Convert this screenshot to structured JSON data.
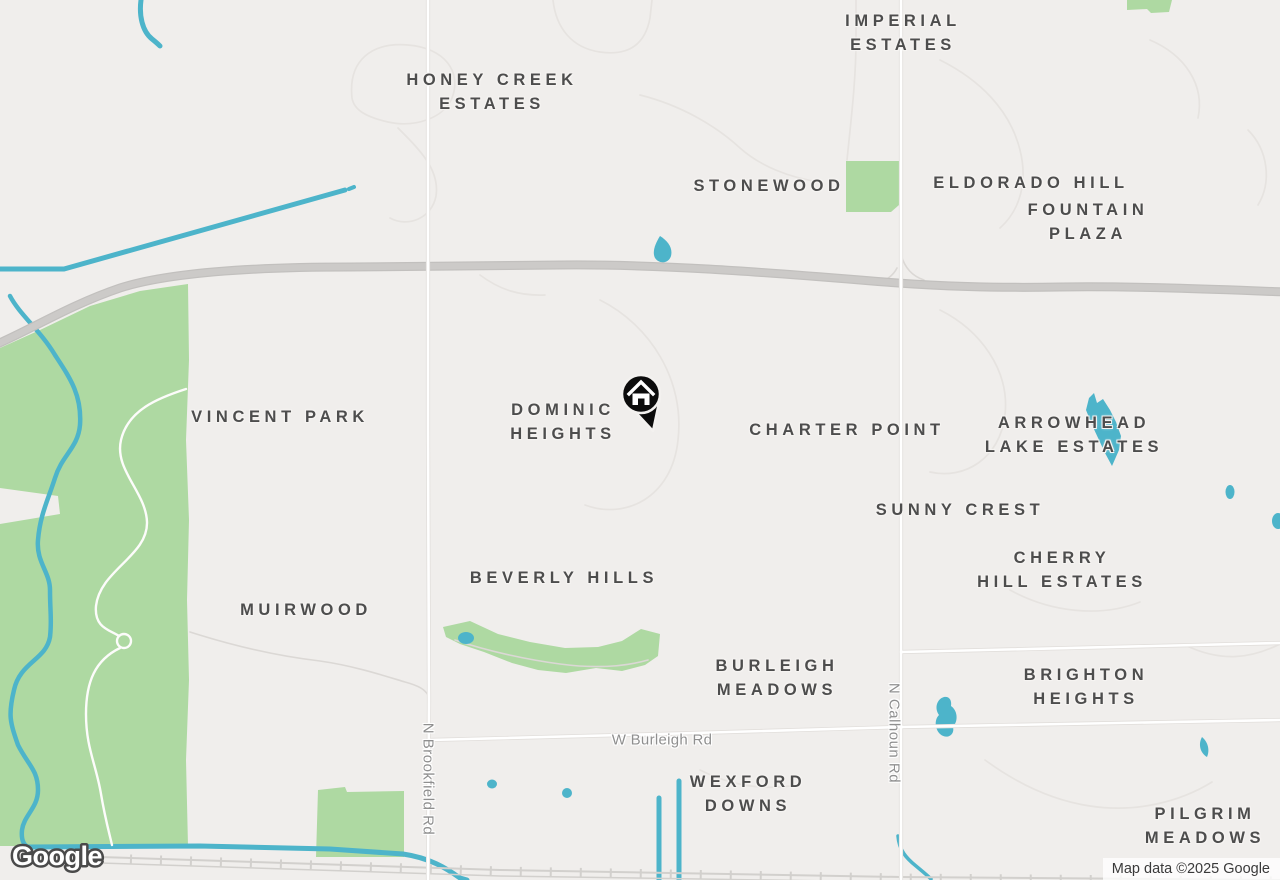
{
  "branding": {
    "logo_text": "Google",
    "attribution": "Map data ©2025 Google"
  },
  "marker": {
    "name": "home marker",
    "icon": "house-icon",
    "color": "#0c0c0c"
  },
  "colors": {
    "background": "#f0eeec",
    "park_green": "#aed9a2",
    "water_blue": "#4db4ca",
    "highway_gray": "#c9c7c5",
    "railroad_gray": "#d2d0cd",
    "minor_road": "#ffffff",
    "place_label": "#4d4d4d",
    "road_label": "#8f8f8f"
  },
  "place_labels": {
    "imperial_estates": "IMPERIAL\nESTATES",
    "honey_creek_estates": "HONEY CREEK\nESTATES",
    "stonewood": "STONEWOOD",
    "eldorado_hill": "ELDORADO HILL",
    "fountain_plaza": "FOUNTAIN PLAZA",
    "vincent_park": "VINCENT PARK",
    "dominic_heights": "DOMINIC\nHEIGHTS",
    "charter_point": "CHARTER POINT",
    "arrowhead_lake_estates": "ARROWHEAD\nLAKE ESTATES",
    "sunny_crest": "SUNNY CREST",
    "cherry_hill_estates": "CHERRY\nHILL ESTATES",
    "beverly_hills": "BEVERLY HILLS",
    "muirwood": "MUIRWOOD",
    "burleigh_meadows": "BURLEIGH\nMEADOWS",
    "brighton_heights": "BRIGHTON\nHEIGHTS",
    "wexford_downs": "WEXFORD\nDOWNS",
    "pilgrim_meadows": "PILGRIM\nMEADOWS"
  },
  "road_labels": {
    "w_burleigh_rd": "W Burleigh Rd",
    "n_brookfield_rd": "N Brookfield Rd",
    "n_calhoun_rd": "N Calhoun Rd"
  }
}
